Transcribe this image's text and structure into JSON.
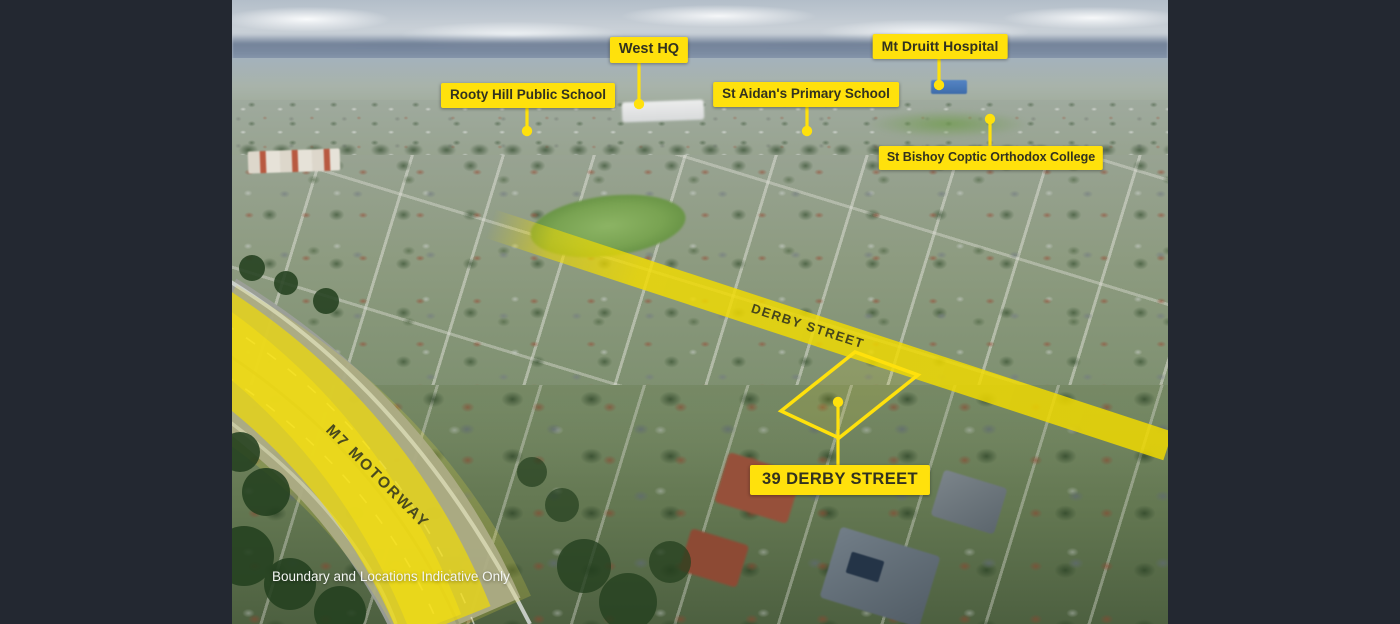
{
  "image": {
    "description": "Aerial suburb photograph with location callouts",
    "disclaimer": "Boundary and Locations Indicative Only"
  },
  "colors": {
    "frame_bg": "#232831",
    "label_bg": "#FFE10C",
    "label_text": "#32321F",
    "highlight_yellow": "#F2DC00",
    "road_text": "#45451C",
    "disclaimer_text": "#F4F6F4"
  },
  "callouts": [
    {
      "id": "west-hq",
      "label": "West HQ"
    },
    {
      "id": "rooty-hill",
      "label": "Rooty Hill Public School"
    },
    {
      "id": "mt-druitt",
      "label": "Mt Druitt Hospital"
    },
    {
      "id": "st-aidans",
      "label": "St Aidan's Primary School"
    },
    {
      "id": "st-bishoy",
      "label": "St Bishoy Coptic Orthodox College"
    },
    {
      "id": "property",
      "label": "39 DERBY STREET"
    }
  ],
  "road_labels": [
    {
      "id": "derby-street",
      "label": "DERBY STREET"
    },
    {
      "id": "m7-motorway",
      "label": "M7 MOTORWAY"
    }
  ]
}
